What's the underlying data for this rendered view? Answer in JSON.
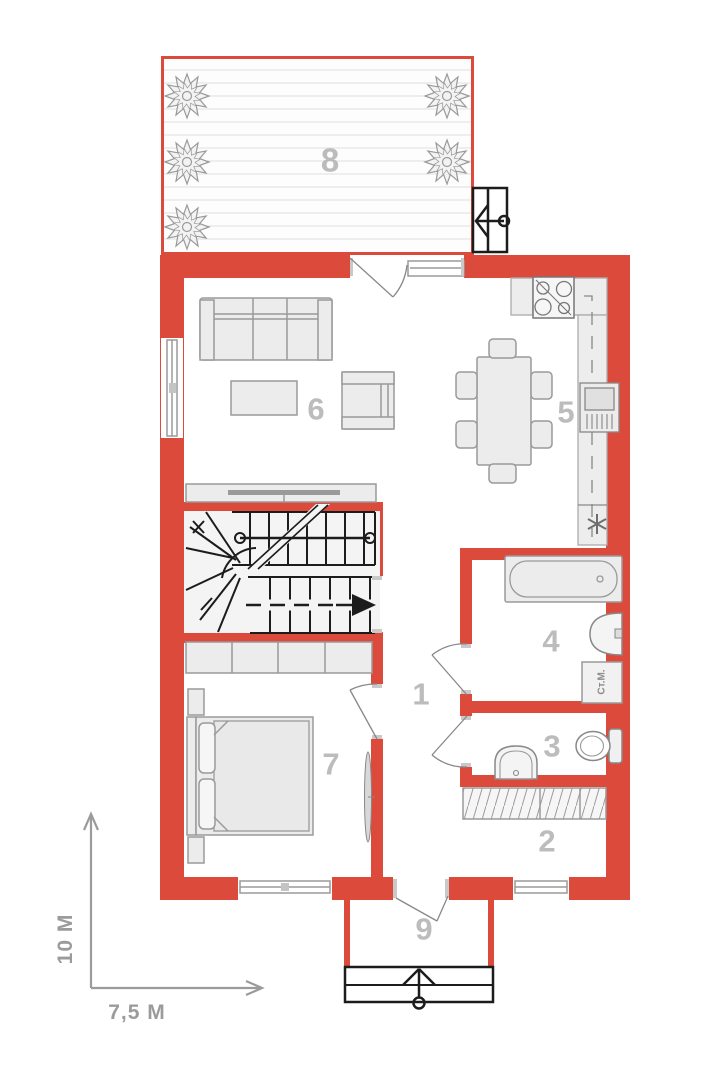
{
  "colors": {
    "wall": "#DC4A3C",
    "line": "#1C1C1C",
    "furniture_fill": "#ECECEC",
    "furniture_stroke": "#9A9A9A",
    "counter_fill": "#EDEDED",
    "label": "#BCBCBC",
    "dimension": "#9B9B9B",
    "deck_line": "#DEDEDE"
  },
  "rooms": [
    {
      "number": "1"
    },
    {
      "number": "2"
    },
    {
      "number": "3"
    },
    {
      "number": "4"
    },
    {
      "number": "5"
    },
    {
      "number": "6"
    },
    {
      "number": "7"
    },
    {
      "number": "8"
    },
    {
      "number": "9"
    }
  ],
  "dimensions": {
    "height_label": "10 M",
    "width_label": "7,5 M"
  },
  "fixtures": {
    "washing_machine_label": "Ст.М."
  },
  "icons": {
    "utility_marker": "✳",
    "gate_arrow": "left-arrow-with-post",
    "steps_arrow": "up-arrow-with-post",
    "plant": "shrub-top-view"
  }
}
